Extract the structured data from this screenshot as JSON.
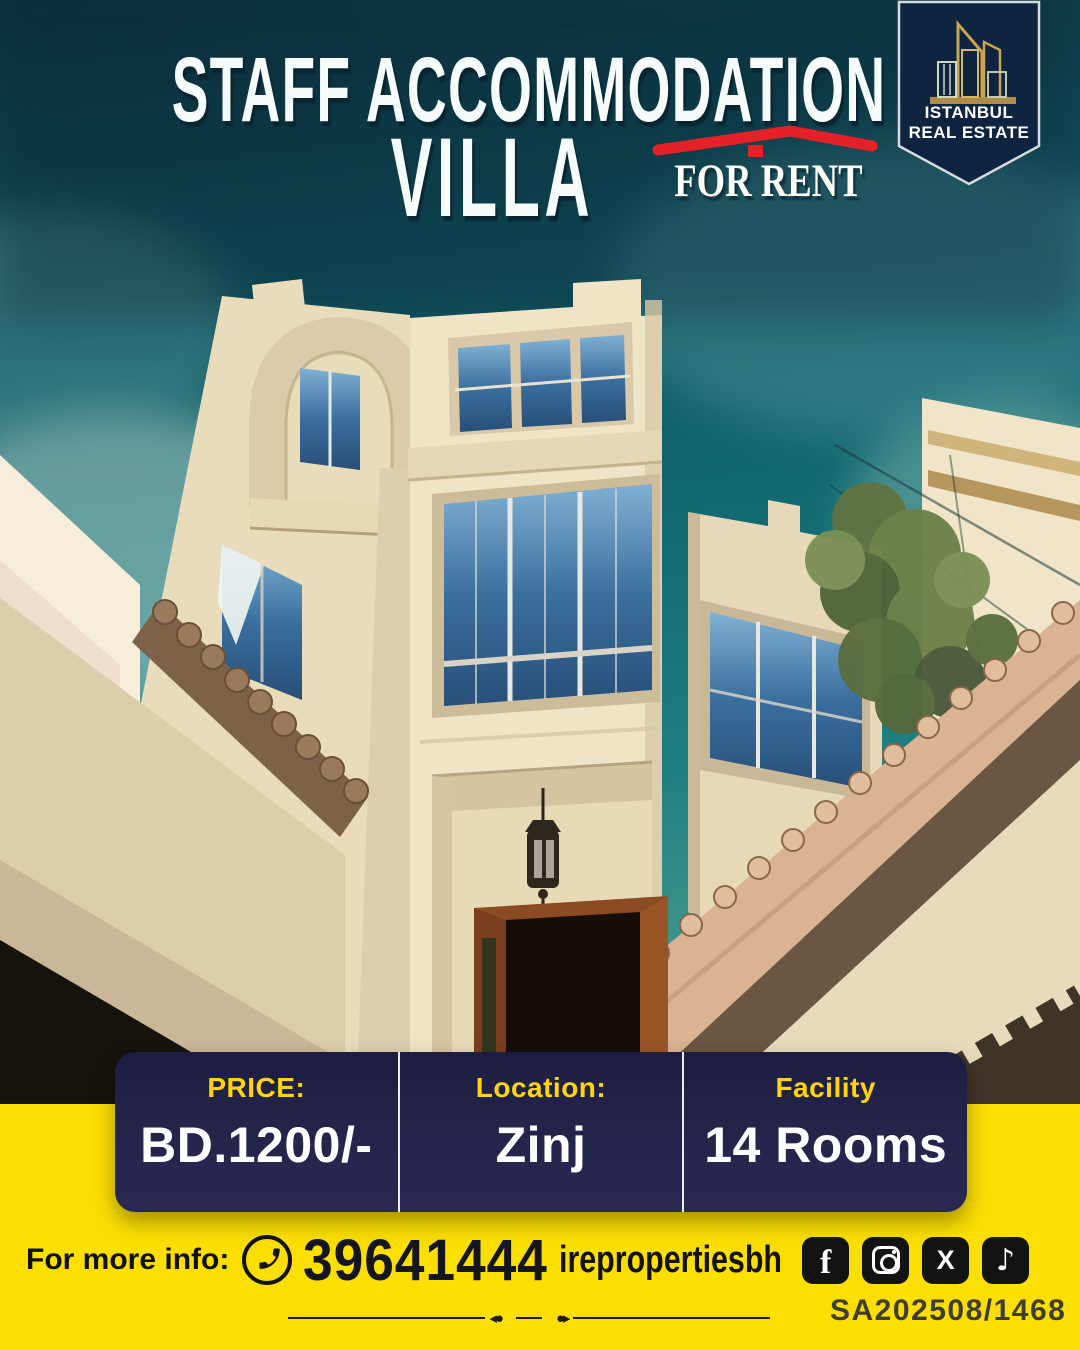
{
  "colors": {
    "accent-yellow": "#fbdf03",
    "bar-navy": "#24244c",
    "label-gold": "#ffd40a",
    "red": "#e42028",
    "badge-navy": "#0e2440",
    "badge-gold": "#c9a452",
    "ink": "#15151e",
    "sky-teal": "#10656e"
  },
  "header": {
    "title_line1": "STAFF ACCOMMODATION",
    "title_line2": "VILLA",
    "for_rent_label": "FOR RENT",
    "brand_line1": "ISTANBUL",
    "brand_line2": "REAL ESTATE"
  },
  "info_bar": {
    "columns": [
      {
        "label": "PRICE:",
        "value": "BD.1200/-"
      },
      {
        "label": "Location:",
        "value": "Zinj"
      },
      {
        "label": "Facility",
        "value": "14 Rooms"
      }
    ]
  },
  "footer": {
    "more_info_label": "For more info:",
    "phone": "39641444",
    "handle": "irepropertiesbh",
    "reference": "SA202508/1468",
    "social": [
      {
        "name": "facebook-icon",
        "glyph": "f"
      },
      {
        "name": "instagram-icon",
        "glyph": ""
      },
      {
        "name": "x-icon",
        "glyph": "X"
      },
      {
        "name": "tiktok-icon",
        "glyph": "♪"
      }
    ]
  }
}
